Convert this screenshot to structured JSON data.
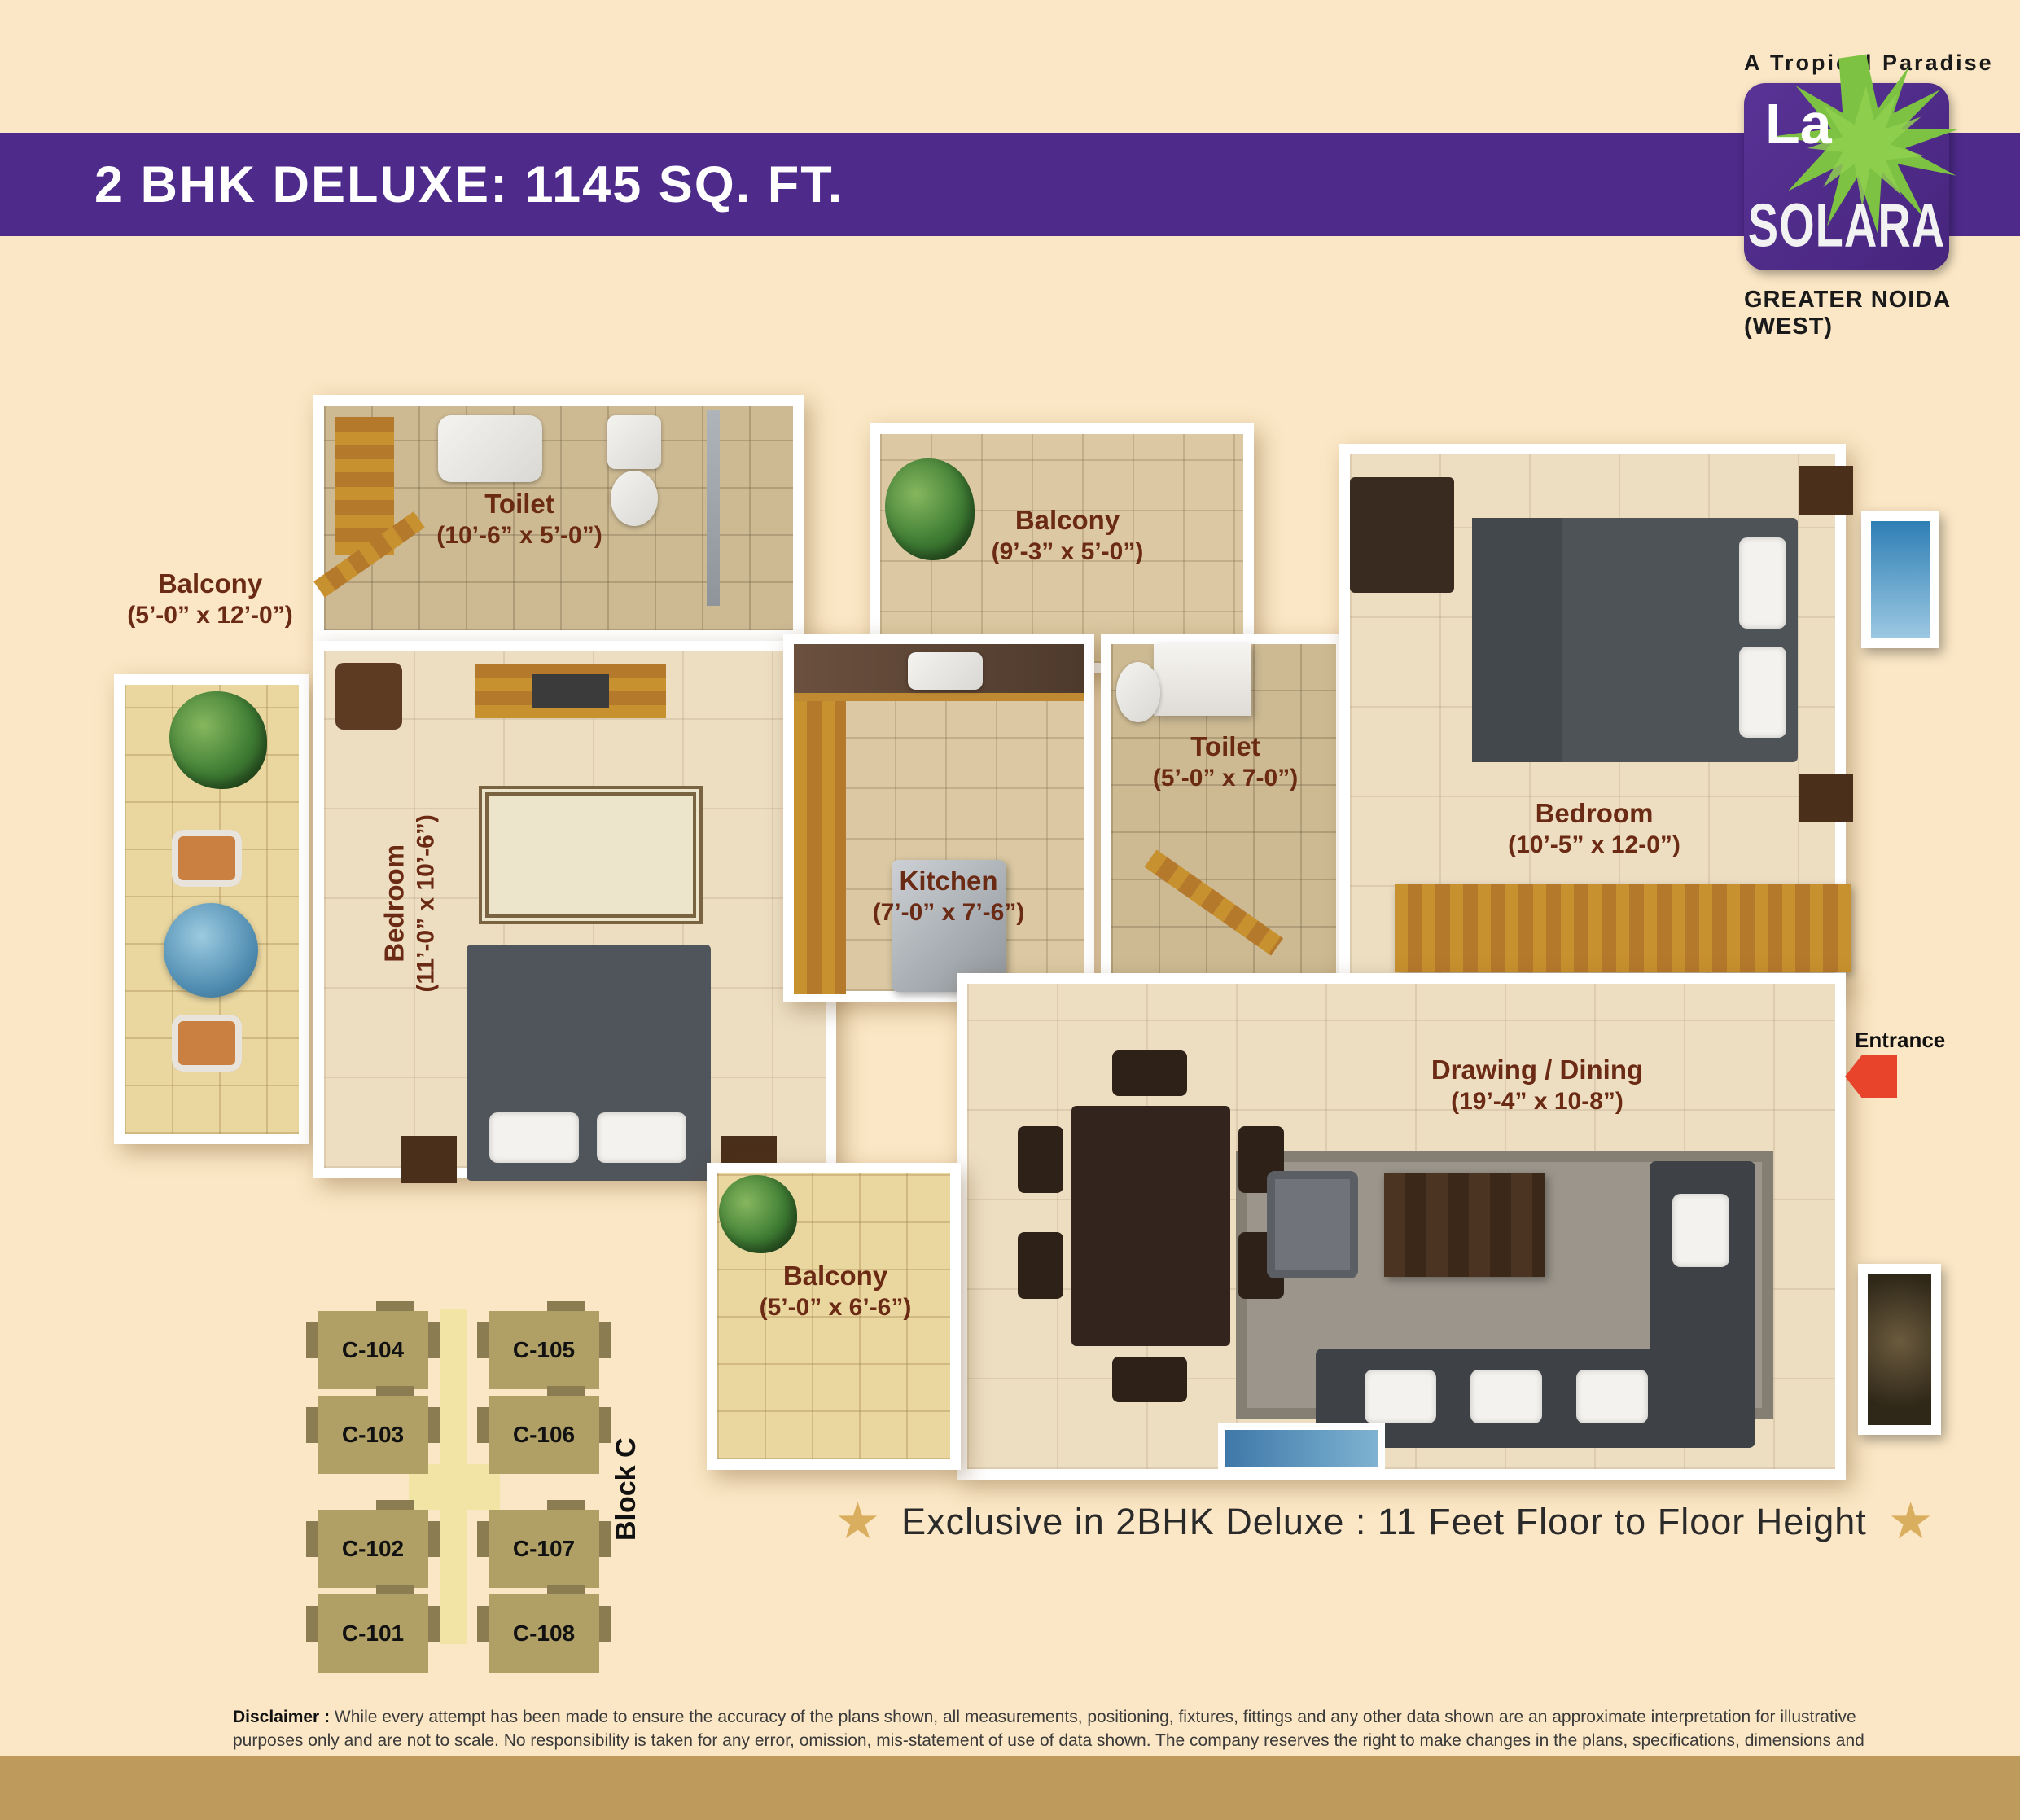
{
  "header": {
    "title": "2 BHK DELUXE: 1145 SQ. FT."
  },
  "brand": {
    "tagline": "A Tropical Paradise",
    "logo_top": "La",
    "logo_main": "SOLARA",
    "location": "GREATER NOIDA (WEST)"
  },
  "colors": {
    "banner_purple": "#4E2A8B",
    "room_label_brown": "#6B2A14",
    "star_gold": "#D9AE5E",
    "entrance_red": "#E8432B",
    "logo_green": "#7DC242",
    "background_cream": "#FBE7C5",
    "bottom_bar_tan": "#BE9B5D"
  },
  "floorplan": {
    "rooms": [
      {
        "id": "balcony-left",
        "name": "Balcony",
        "dims": "(5’-0” x 12’-0”)"
      },
      {
        "id": "toilet-left",
        "name": "Toilet",
        "dims": "(10’-6” x 5’-0”)"
      },
      {
        "id": "balcony-top",
        "name": "Balcony",
        "dims": "(9’-3” x 5’-0”)"
      },
      {
        "id": "toilet-mid",
        "name": "Toilet",
        "dims": "(5’-0” x 7-0”)"
      },
      {
        "id": "bedroom-right",
        "name": "Bedroom",
        "dims": "(10’-5” x 12-0”)"
      },
      {
        "id": "bedroom-left",
        "name": "Bedroom",
        "dims": "(11’-0” x 10’-6”)"
      },
      {
        "id": "kitchen",
        "name": "Kitchen",
        "dims": "(7’-0” x 7’-6”)"
      },
      {
        "id": "drawing-dining",
        "name": "Drawing / Dining",
        "dims": "(19’-4” x 10-8”)"
      },
      {
        "id": "balcony-bottom",
        "name": "Balcony",
        "dims": "(5’-0” x 6’-6”)"
      }
    ],
    "entrance_label": "Entrance"
  },
  "keyplan": {
    "block_label": "Block C",
    "units": [
      "C-104",
      "C-105",
      "C-103",
      "C-106",
      "C-102",
      "C-107",
      "C-101",
      "C-108"
    ]
  },
  "highlight": {
    "star": "★",
    "text": "Exclusive in 2BHK Deluxe : 11 Feet Floor to Floor Height"
  },
  "disclaimer": {
    "label": "Disclaimer :",
    "text": " While every attempt has been made to ensure the accuracy of the plans shown, all measurements, positioning, fixtures, fittings and any other data shown are an approximate interpretation for illustrative purposes only and are not to scale. No responsibility is taken for any error, omission, mis-statement of use of data shown. The company reserves the right to make changes in the plans, specifications, dimensions and elevations without any prior notice. 1 sq. ft. = 0.0929 sq. mt., 1 sq. mt.= 10.764 sq. ft., 1 ft. = 0.305 mt. and 1 mt. = 3.281 ft."
  }
}
